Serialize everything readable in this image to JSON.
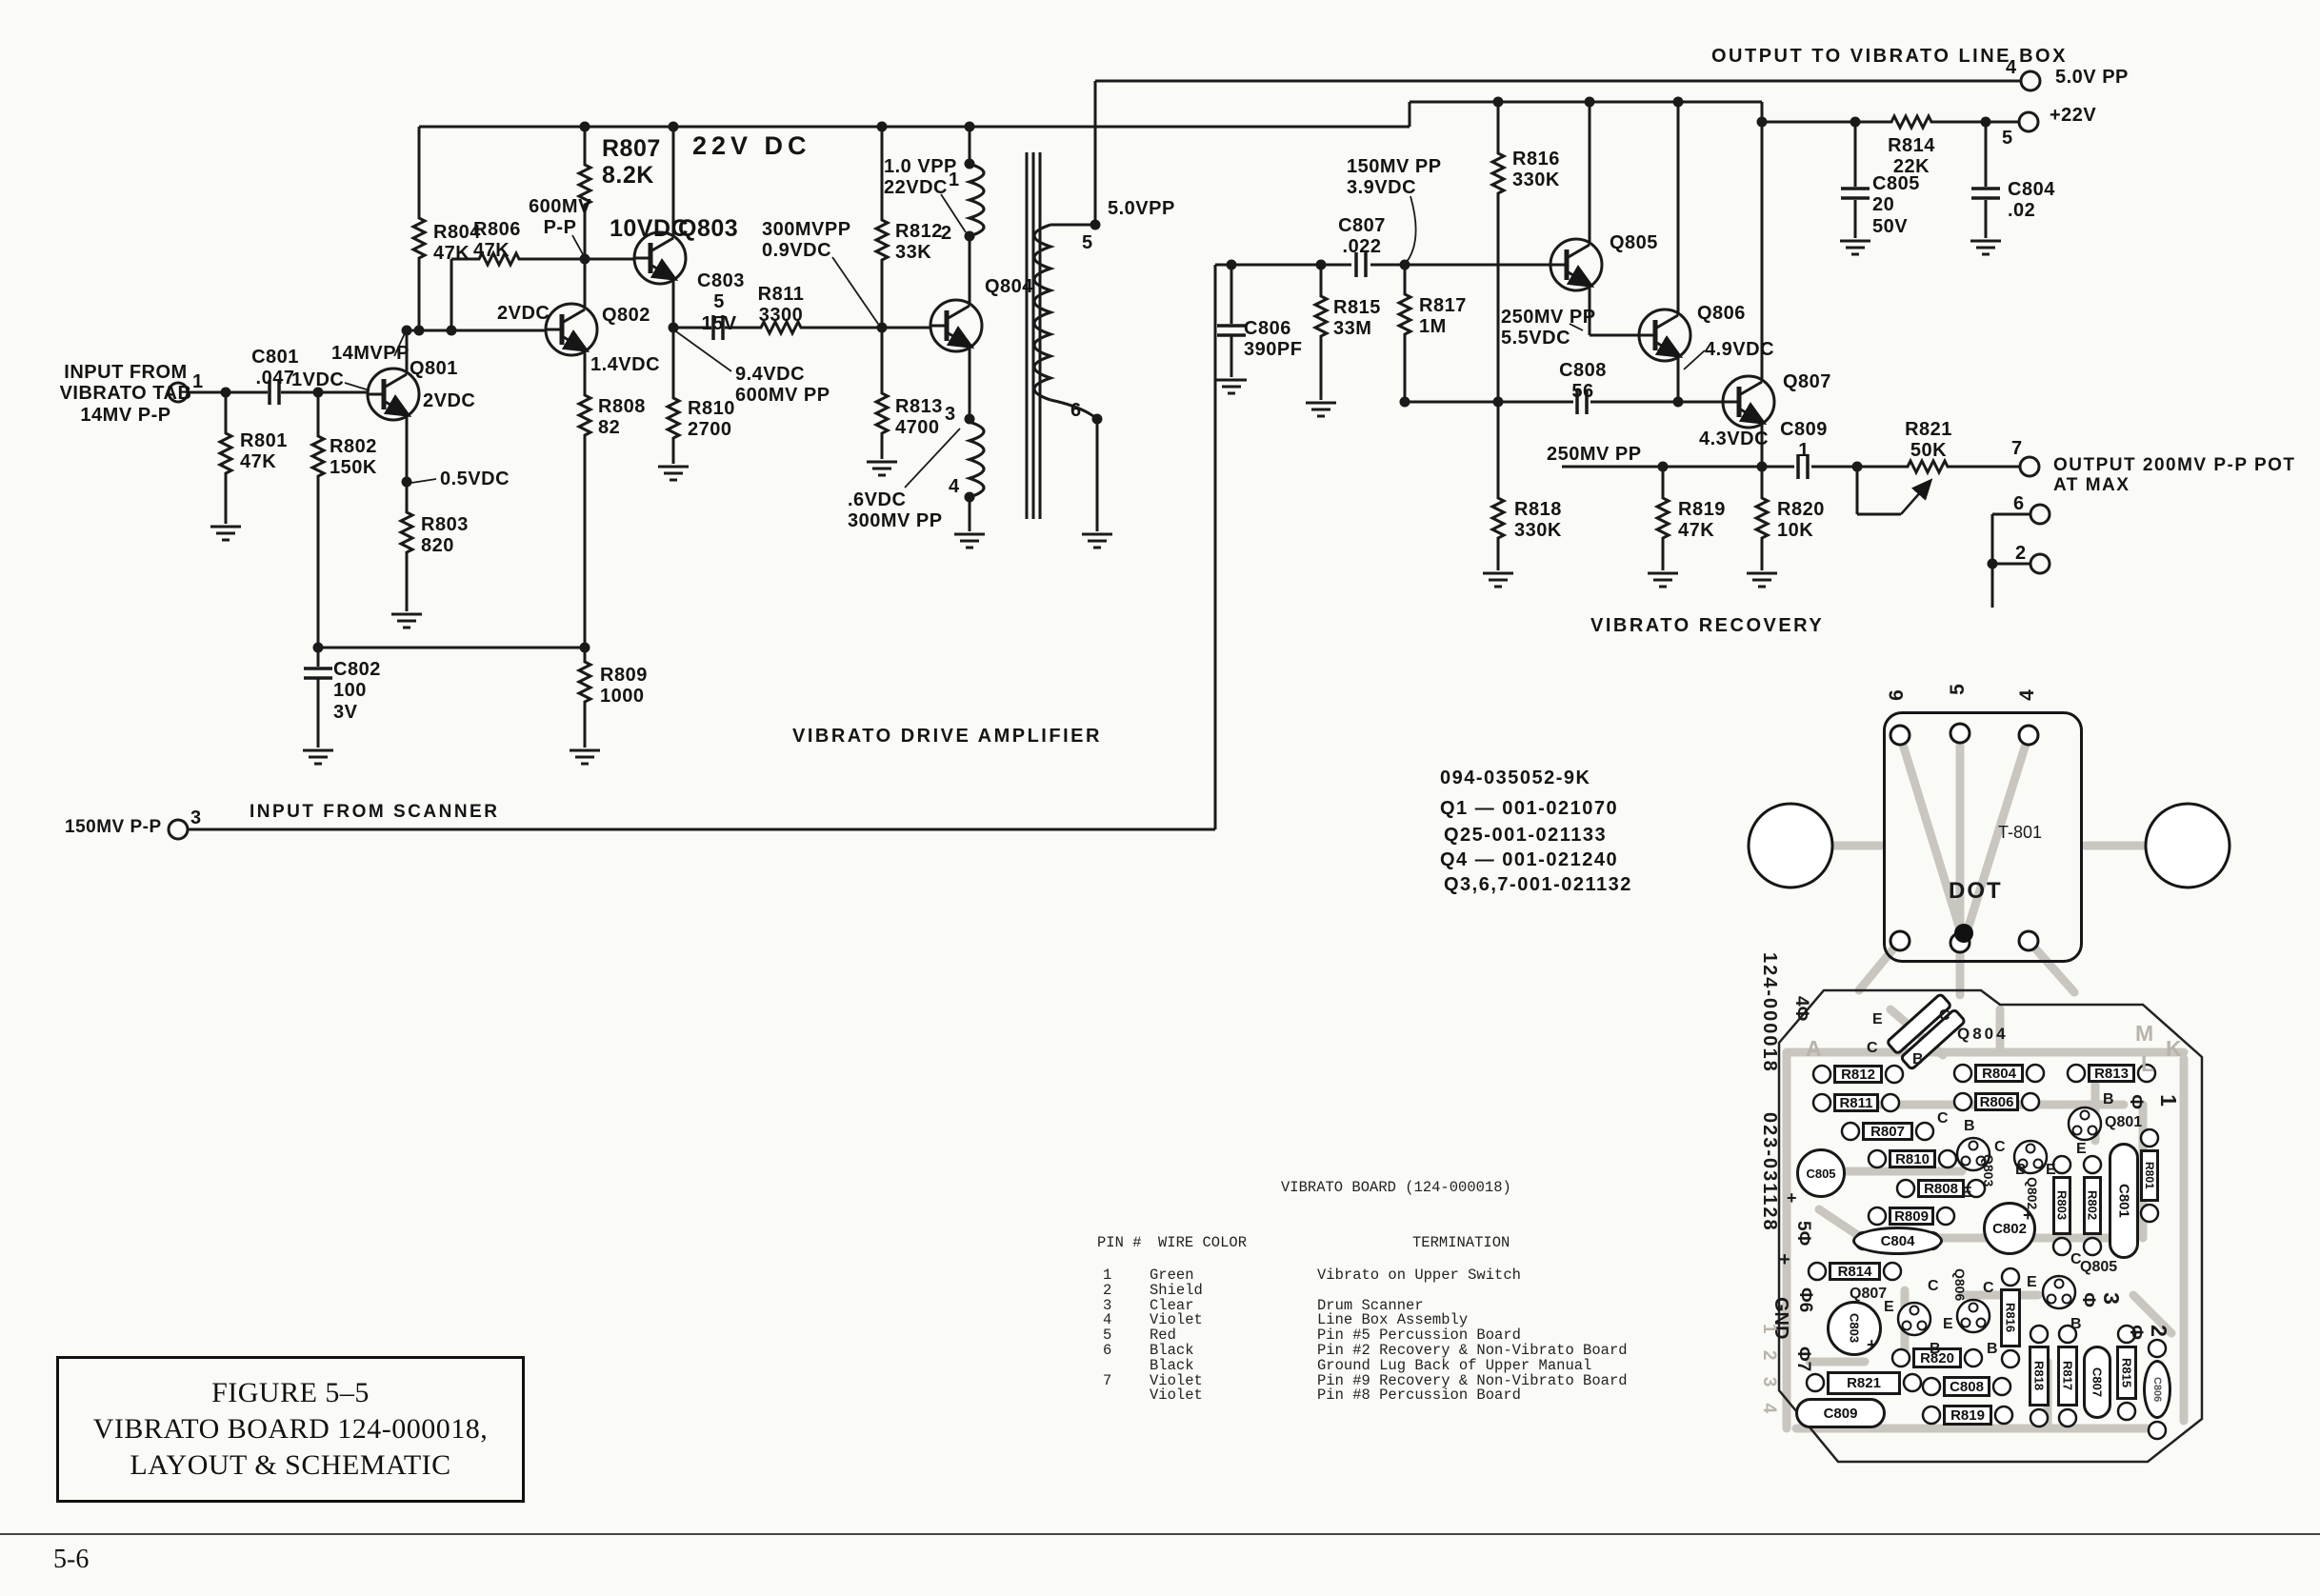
{
  "doc": {
    "page_number": "5-6"
  },
  "caption": {
    "line1": "FIGURE 5–5",
    "line2": "VIBRATO BOARD 124-000018,",
    "line3": "LAYOUT & SCHEMATIC"
  },
  "part_numbers": {
    "l1": "094-035052-9K",
    "l2": "Q1 — 001-021070",
    "l3": "Q25-001-021133",
    "l4": "Q4 — 001-021240",
    "l5": "Q3,6,7-001-021132"
  },
  "table": {
    "title": "VIBRATO BOARD (124-000018)",
    "col_pin": "PIN #",
    "col_color": "WIRE COLOR",
    "col_term": "TERMINATION",
    "rows": [
      {
        "pin": "1",
        "color": "Green",
        "term": "Vibrato on Up­per Switch"
      },
      {
        "pin": "2",
        "color": "Shield",
        "term": ""
      },
      {
        "pin": "3",
        "color": "Clear",
        "term": "Drum Scanner"
      },
      {
        "pin": "4",
        "color": "Violet",
        "term": "Line Box Assembly"
      },
      {
        "pin": "5",
        "color": "Red",
        "term": "Pin #5 Percussion Board"
      },
      {
        "pin": "6",
        "color": "Black",
        "term": "Pin #2 Recovery & Non-Vibrato Board"
      },
      {
        "pin": "",
        "color": "Black",
        "term": "Ground Lug Back of Upper Manual"
      },
      {
        "pin": "7",
        "color": "Violet",
        "term": "Pin #9 Recovery & Non-Vibrato Board"
      },
      {
        "pin": "",
        "color": "Violet",
        "term": "Pin #8 Percussion Board"
      }
    ]
  },
  "sch": {
    "input_tab": "INPUT FROM\nVIBRATO TAB\n14MV P-P",
    "pin1": "1",
    "pin3": "3",
    "scanner": "INPUT FROM SCANNER",
    "mv150": "150MV P-P",
    "r801": "R801\n47K",
    "c801": "C801\n.047",
    "r802": "R802\n150K",
    "vdc1": "1VDC",
    "q801": "Q801",
    "vdc2a": "2VDC",
    "mvpp14": "14MVPP",
    "vdc05": "0.5VDC",
    "r803": "R803\n820",
    "c802": "C802\n100\n3V",
    "r804": "R804\n47K",
    "r806": "R806\n47K",
    "mv600": "600MV\nP-P",
    "r807": "R807\n8.2K",
    "v22dc": "22V DC",
    "vdc10": "10VDC",
    "q803": "Q803",
    "vdc2b": "2VDC",
    "q802": "Q802",
    "vdc14": "1.4VDC",
    "r808": "R808\n82",
    "r809": "R809\n1000",
    "c803": "C803\n5\n15V",
    "r811": "R811\n3300",
    "r810": "R810\n2700",
    "vdc94": "9.4VDC\n600MV PP",
    "mvpp300": "300MVPP\n0.9VDC",
    "r812": "R812\n33K",
    "vpp10": "1.0 VPP\n22VDC",
    "r813": "R813\n4700",
    "vdc6": ".6VDC\n300MV PP",
    "q804": "Q804",
    "tp1": "1",
    "tp2": "2",
    "tp3": "3",
    "tp4": "4",
    "tp5": "5",
    "tp6": "6",
    "vpp50a": "5.0VPP",
    "linebox": "OUTPUT TO VIBRATO LINE BOX",
    "pin4": "4",
    "vpp50b": "5.0V PP",
    "pin5": "5",
    "v22": "+22V",
    "r814": "R814\n22K",
    "c805": "C805\n20\n50V",
    "c804": "C804\n.02",
    "mvpp150": "150MV PP\n3.9VDC",
    "c807": "C807\n.022",
    "c806": "C806\n390PF",
    "r815": "R815\n33M",
    "r817": "R817\n1M",
    "r816": "R816\n330K",
    "q805": "Q805",
    "mvpp250a": "250MV PP\n5.5VDC",
    "c808": "C808\n56",
    "q806": "Q806",
    "vdc49": "4.9VDC",
    "q807": "Q807",
    "vdc43": "4.3VDC",
    "c809": "C809\n1",
    "r821": "R821\n50K",
    "pin7": "7",
    "out200": "OUTPUT 200MV P-P POT AT MAX",
    "pin6": "6",
    "pin2": "2",
    "r818": "R818\n330K",
    "r819": "R819\n47K",
    "r820": "R820\n10K",
    "mvpp250b": "250MV PP",
    "recovery": "VIBRATO RECOVERY",
    "driveamp": "VIBRATO DRIVE AMPLIFIER"
  },
  "pcb": {
    "t801": "T-801",
    "dot_label": "DOT",
    "pin_top_6": "6",
    "pin_top_5": "5",
    "pin_top_4": "4",
    "serial1": "124-000018",
    "serial2": "023-031128",
    "phi4": "4Φ",
    "phi5": "5Φ",
    "plus": "+",
    "phi6": "Φ6",
    "gnd": "GND",
    "phi7": "Φ7",
    "edge_nums": "1 2 3 4",
    "rp1": "1",
    "rp2": "2",
    "rp3": "3",
    "phi": "Φ",
    "letters": {
      "e": "E",
      "c": "C",
      "b": "B"
    },
    "ghost": {
      "m": "M",
      "k": "K",
      "l": "L",
      "a": "A"
    },
    "refs": {
      "r801": "R801",
      "r802": "R802",
      "r803": "R803",
      "r804": "R804",
      "r806": "R806",
      "r807": "R807",
      "r808": "R808",
      "r809": "R809",
      "r810": "R810",
      "r811": "R811",
      "r812": "R812",
      "r813": "R813",
      "r814": "R814",
      "r815": "R815",
      "r816": "R816",
      "r817": "R817",
      "r818": "R818",
      "r819": "R819",
      "r820": "R820",
      "r821": "R821",
      "c801": "C801",
      "c802": "C802",
      "c803": "C803",
      "c804": "C804",
      "c805": "C805",
      "c806": "C806",
      "c807": "C807",
      "c808": "C808",
      "c809": "C809",
      "q801": "Q801",
      "q802": "Q802",
      "q803": "Q803",
      "q804": "Q804",
      "q805": "Q805",
      "q806": "Q806",
      "q807": "Q807"
    }
  }
}
